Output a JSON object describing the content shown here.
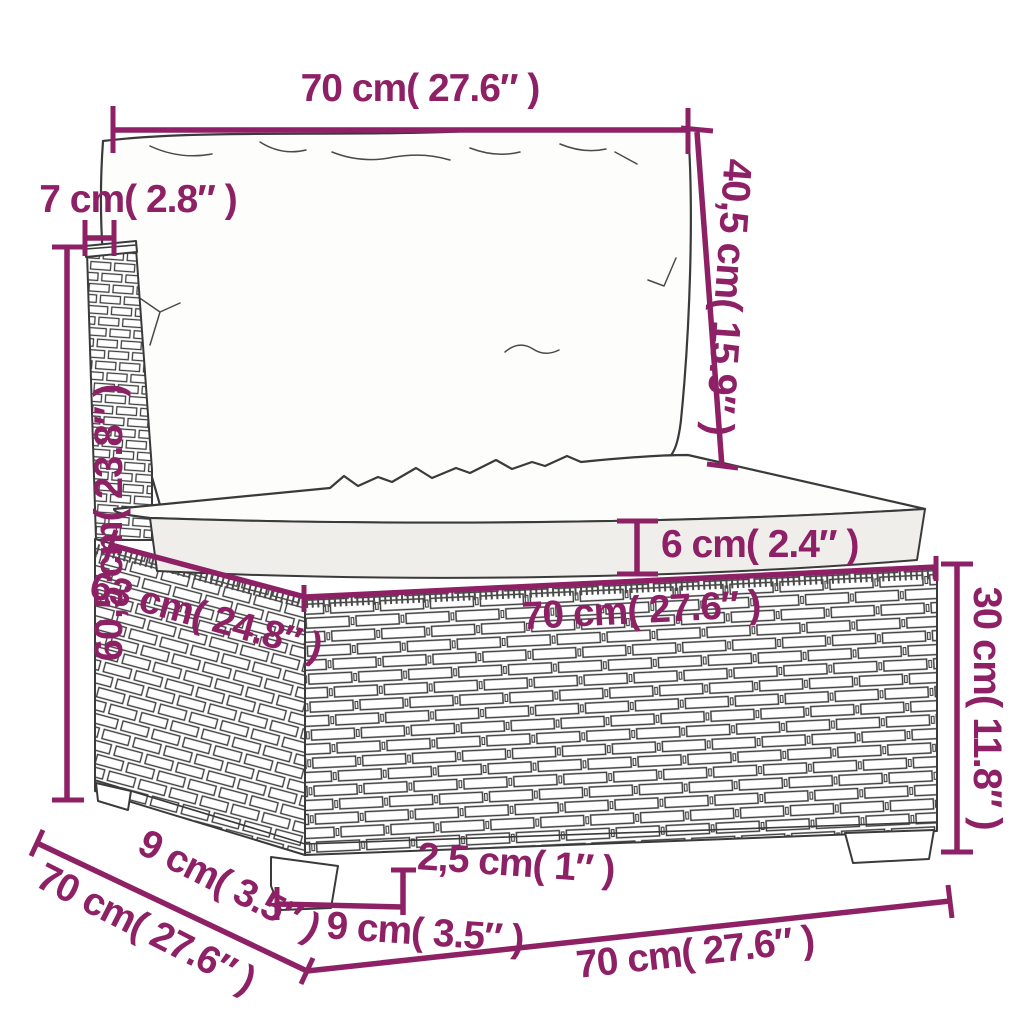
{
  "colors": {
    "accent": "#8e2166",
    "line_art": "#3a3a3a",
    "background": "#ffffff"
  },
  "dimensions": {
    "top_width": "70 cm( 27.6″ )",
    "backrest_post_width": "7 cm( 2.8″ )",
    "backrest_height": "60,5 cm( 23.8″ )",
    "back_cushion_height": "40,5 cm( 15.9″ )",
    "seat_cushion_thickness": "6 cm( 2.4″ )",
    "seat_width": "70 cm( 27.6″ )",
    "seat_depth": "63 cm( 24.8″ )",
    "base_height": "30 cm( 11.8″ )",
    "foot_inset_depth": "9 cm( 3.5″ )",
    "total_depth": "70 cm( 27.6″ )",
    "foot_width": "9 cm( 3.5″ )",
    "foot_height": "2,5 cm( 1″ )",
    "total_width": "70 cm( 27.6″ )"
  }
}
